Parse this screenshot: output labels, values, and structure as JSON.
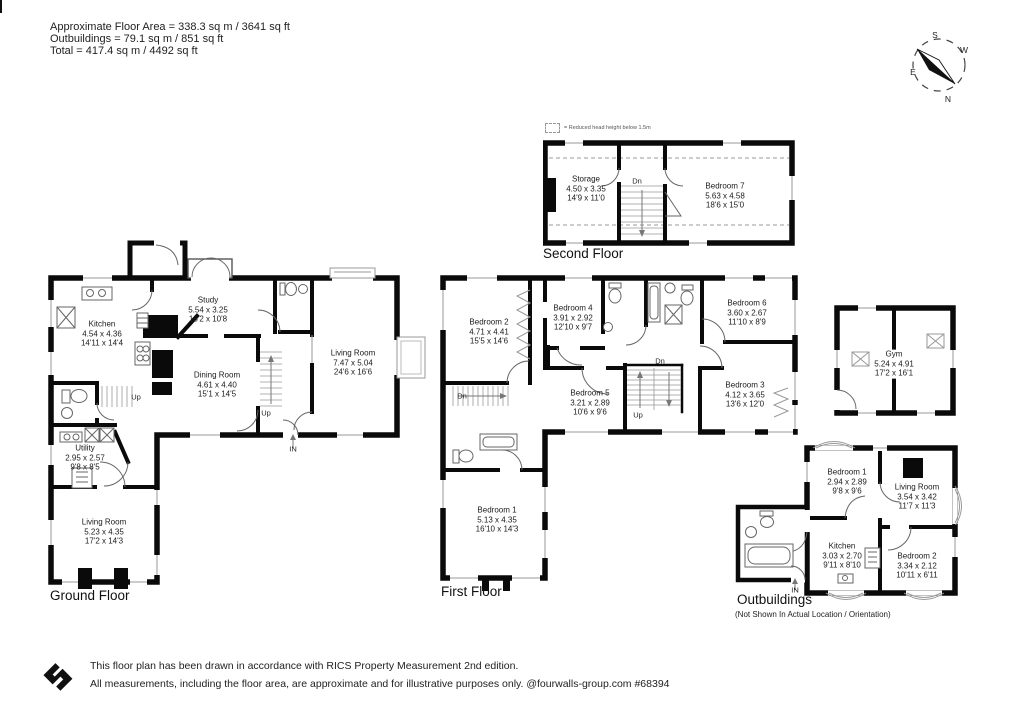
{
  "header": {
    "line1": "Approximate Floor Area = 338.3 sq m / 3641 sq ft",
    "line2": "Outbuildings = 79.1 sq m / 851 sq ft",
    "line3": "Total = 417.4 sq m / 4492 sq ft"
  },
  "compass": {
    "north": "N",
    "south": "S",
    "east": "E",
    "west": "W"
  },
  "legend": {
    "text": "= Reduced head height below 1.5m"
  },
  "stairs": {
    "up": "Up",
    "down": "Dn",
    "entrance": "IN"
  },
  "floors": {
    "second": {
      "title": "Second Floor",
      "rooms": {
        "storage": {
          "name": "Storage",
          "metric": "4.50 x 3.35",
          "imperial": "14'9 x 11'0"
        },
        "bedroom7": {
          "name": "Bedroom 7",
          "metric": "5.63 x 4.58",
          "imperial": "18'6 x 15'0"
        }
      }
    },
    "ground": {
      "title": "Ground Floor",
      "rooms": {
        "kitchen": {
          "name": "Kitchen",
          "metric": "4.54 x 4.36",
          "imperial": "14'11 x 14'4"
        },
        "study": {
          "name": "Study",
          "metric": "5.54 x 3.25",
          "imperial": "18'2 x 10'8"
        },
        "dining": {
          "name": "Dining Room",
          "metric": "4.61 x 4.40",
          "imperial": "15'1 x 14'5"
        },
        "living_main": {
          "name": "Living Room",
          "metric": "7.47 x 5.04",
          "imperial": "24'6 x 16'6"
        },
        "utility": {
          "name": "Utility",
          "metric": "2.95 x 2.57",
          "imperial": "9'8 x 8'5"
        },
        "living_second": {
          "name": "Living Room",
          "metric": "5.23 x 4.35",
          "imperial": "17'2 x 14'3"
        }
      }
    },
    "first": {
      "title": "First Floor",
      "rooms": {
        "bedroom2": {
          "name": "Bedroom 2",
          "metric": "4.71 x 4.41",
          "imperial": "15'5 x 14'6"
        },
        "bedroom4": {
          "name": "Bedroom 4",
          "metric": "3.91 x 2.92",
          "imperial": "12'10 x 9'7"
        },
        "bedroom6": {
          "name": "Bedroom 6",
          "metric": "3.60 x 2.67",
          "imperial": "11'10 x 8'9"
        },
        "bedroom5": {
          "name": "Bedroom 5",
          "metric": "3.21 x 2.89",
          "imperial": "10'6 x 9'6"
        },
        "bedroom3": {
          "name": "Bedroom 3",
          "metric": "4.12 x 3.65",
          "imperial": "13'6 x 12'0"
        },
        "bedroom1": {
          "name": "Bedroom 1",
          "metric": "5.13 x 4.35",
          "imperial": "16'10 x 14'3"
        }
      }
    },
    "gym": {
      "rooms": {
        "gym": {
          "name": "Gym",
          "metric": "5.24 x 4.91",
          "imperial": "17'2 x 16'1"
        }
      }
    },
    "outbuildings": {
      "title": "Outbuildings",
      "subtitle": "(Not Shown In Actual Location / Orientation)",
      "rooms": {
        "bedroom1": {
          "name": "Bedroom 1",
          "metric": "2.94 x 2.89",
          "imperial": "9'8 x 9'6"
        },
        "living": {
          "name": "Living Room",
          "metric": "3.54 x 3.42",
          "imperial": "11'7 x 11'3"
        },
        "kitchen": {
          "name": "Kitchen",
          "metric": "3.03 x 2.70",
          "imperial": "9'11 x 8'10"
        },
        "bedroom2": {
          "name": "Bedroom 2",
          "metric": "3.34 x 2.12",
          "imperial": "10'11 x 6'11"
        }
      }
    }
  },
  "footer": {
    "line1": "This floor plan has been drawn in accordance with RICS Property Measurement 2nd edition.",
    "line2": "All measurements, including the floor area, are approximate and for illustrative purposes only. @fourwalls-group.com #68394"
  },
  "colors": {
    "wall": "#0a0a0a",
    "window": "#999999",
    "background": "#ffffff"
  }
}
